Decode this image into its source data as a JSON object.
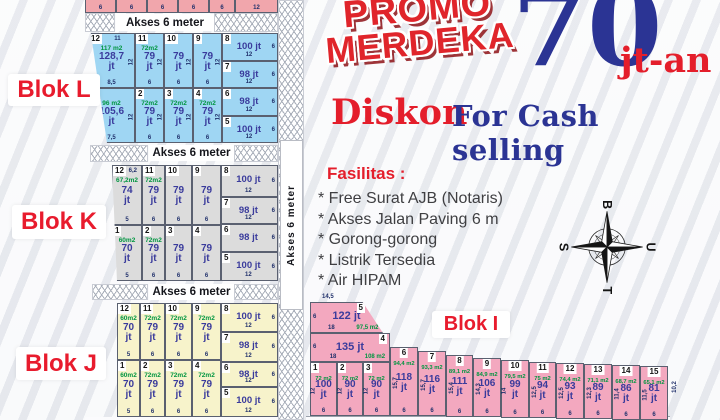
{
  "labels": {
    "akses": "Akses 6 meter"
  },
  "promo": {
    "badge_line1": "PROMO",
    "badge_line2": "MERDEKA",
    "price": "70",
    "price_suffix": "jt-an",
    "discount_word": "Diskon",
    "discount_rest": "For Cash selling"
  },
  "facilities": {
    "title": "Fasilitas :",
    "items": [
      "* Free Surat AJB (Notaris)",
      "* Akses Jalan Paving 6 m",
      "* Gorong-gorong",
      "* Listrik Tersedia",
      "* Air HIPAM"
    ]
  },
  "compass": {
    "top": "B",
    "right": "U",
    "bottom": "T",
    "left": "S"
  },
  "top_strip": {
    "color": "#f1a6ac",
    "dims": [
      "6",
      "6",
      "6",
      "6",
      "6",
      "12"
    ]
  },
  "blocks": {
    "L": {
      "label": "Blok L",
      "color": "#9fd6f3",
      "top_row": [
        {
          "num": "12",
          "top": "11",
          "area": "117 m2",
          "price": "128,7 jt",
          "bottom": "8,5",
          "side": "12"
        },
        {
          "num": "11",
          "area": "72m2",
          "price": "79 jt",
          "bottom": "6",
          "side": "12"
        },
        {
          "num": "10",
          "price": "79 jt",
          "bottom": "6",
          "side": "12"
        },
        {
          "num": "9",
          "price": "79 jt",
          "bottom": "6",
          "side": "12"
        }
      ],
      "bottom_row": [
        {
          "num": "1",
          "area": "96 m2",
          "price": "105,6 jt",
          "bottom": "7,5",
          "side": "12"
        },
        {
          "num": "2",
          "area": "72m2",
          "price": "79 jt",
          "bottom": "6",
          "side": "12"
        },
        {
          "num": "3",
          "area": "72m2",
          "price": "79 jt",
          "bottom": "6",
          "side": "12"
        },
        {
          "num": "4",
          "area": "72m2",
          "price": "79 jt",
          "bottom": "6",
          "side": "12"
        }
      ],
      "right_col": [
        {
          "num": "8",
          "price": "100 jt",
          "side": "6",
          "bottom": "12"
        },
        {
          "num": "7",
          "price": "98 jt",
          "side": "6",
          "bottom": "12"
        },
        {
          "num": "6",
          "price": "98 jt",
          "side": "6",
          "bottom": "12"
        },
        {
          "num": "5",
          "price": "100 jt",
          "side": "6",
          "bottom": "12"
        }
      ]
    },
    "K": {
      "label": "Blok K",
      "color": "#dcdcdc",
      "top_row": [
        {
          "num": "12",
          "top": "6,2",
          "area": "67,2m2",
          "price": "74 jt",
          "bottom": "5"
        },
        {
          "num": "11",
          "area": "72m2",
          "price": "79 jt",
          "bottom": "6"
        },
        {
          "num": "10",
          "price": "79 jt",
          "bottom": "6"
        },
        {
          "num": "9",
          "price": "79 jt",
          "bottom": "6"
        }
      ],
      "bottom_row": [
        {
          "num": "1",
          "area": "60m2",
          "price": "70 jt",
          "bottom": "5"
        },
        {
          "num": "2",
          "area": "72m2",
          "price": "79 jt",
          "bottom": "6"
        },
        {
          "num": "3",
          "price": "79 jt",
          "bottom": "6"
        },
        {
          "num": "4",
          "price": "79 jt",
          "bottom": "6"
        }
      ],
      "right_col": [
        {
          "num": "8",
          "price": "100 jt",
          "side": "6",
          "bottom": "12"
        },
        {
          "num": "7",
          "price": "98 jt",
          "side": "6",
          "bottom": "12"
        },
        {
          "num": "6",
          "price": "98 jt",
          "side": "6"
        },
        {
          "num": "5",
          "price": "100 jt",
          "side": "6",
          "bottom": "12"
        }
      ]
    },
    "J": {
      "label": "Blok J",
      "color": "#f7f3cb",
      "top_row": [
        {
          "num": "12",
          "area": "60m2",
          "price": "70 jt",
          "bottom": "5"
        },
        {
          "num": "11",
          "area": "72m2",
          "price": "79 jt",
          "bottom": "6"
        },
        {
          "num": "10",
          "area": "72m2",
          "price": "79 jt",
          "bottom": "6"
        },
        {
          "num": "9",
          "area": "72m2",
          "price": "79 jt",
          "bottom": "6"
        }
      ],
      "bottom_row": [
        {
          "num": "1",
          "area": "60m2",
          "price": "70 jt",
          "bottom": "5"
        },
        {
          "num": "2",
          "area": "72m2",
          "price": "79 jt",
          "bottom": "6"
        },
        {
          "num": "3",
          "area": "72m2",
          "price": "79 jt",
          "bottom": "6"
        },
        {
          "num": "4",
          "area": "72m2",
          "price": "79 jt",
          "bottom": "6"
        }
      ],
      "right_col": [
        {
          "num": "8",
          "price": "100 jt",
          "side": "6",
          "bottom": "12"
        },
        {
          "num": "7",
          "price": "98 jt",
          "side": "6",
          "bottom": "12"
        },
        {
          "num": "6",
          "price": "98 jt",
          "side": "6",
          "bottom": "12"
        },
        {
          "num": "5",
          "price": "100 jt",
          "side": "6",
          "bottom": "12"
        }
      ]
    },
    "I": {
      "label": "Blok I",
      "color": "#f3a8bf",
      "plots": [
        {
          "num": "5",
          "price": "122 jt",
          "top": "14,5",
          "left": "6",
          "bottom": "18",
          "area": "97,5 m2"
        },
        {
          "num": "4",
          "price": "135 jt",
          "left": "6",
          "bottom": "18",
          "area": "108 m2"
        },
        {
          "num": "1",
          "area": "72 m2",
          "price": "100 jt",
          "side": "12",
          "bottom": "6"
        },
        {
          "num": "2",
          "area": "72 m2",
          "price": "90 jt",
          "side": "12",
          "bottom": "6"
        },
        {
          "num": "3",
          "area": "72 m2",
          "price": "90 jt",
          "side": "12",
          "bottom": "6"
        },
        {
          "num": "6",
          "area": "94,4 m2",
          "price": "118 jt",
          "side": "15,7",
          "bottom": "6"
        },
        {
          "num": "7",
          "area": "93,3 m2",
          "price": "116 jt",
          "side": "15,7",
          "bottom": "6"
        },
        {
          "num": "8",
          "area": "89,1 m2",
          "price": "111 jt",
          "side": "15,4",
          "bottom": "6"
        },
        {
          "num": "9",
          "area": "84,9 m2",
          "price": "106 jt",
          "side": "14,3",
          "bottom": "6"
        },
        {
          "num": "10",
          "area": "79,5 m2",
          "price": "99 jt",
          "side": "14",
          "bottom": "6"
        },
        {
          "num": "11",
          "area": "75 m2",
          "price": "94 jt",
          "side": "12,5",
          "bottom": "6"
        },
        {
          "num": "12",
          "area": "74,4 m2",
          "price": "93 jt",
          "side": "12,5",
          "bottom": "6"
        },
        {
          "num": "13",
          "area": "71,1 m2",
          "price": "89 jt",
          "side": "12,3",
          "bottom": "6"
        },
        {
          "num": "14",
          "area": "68,7 m2",
          "price": "86 jt",
          "side": "11,4",
          "bottom": "6"
        },
        {
          "num": "15",
          "area": "65,1 m2",
          "price": "81 jt",
          "side": "11,5",
          "bottom": "6",
          "right": "10,2"
        }
      ]
    }
  }
}
